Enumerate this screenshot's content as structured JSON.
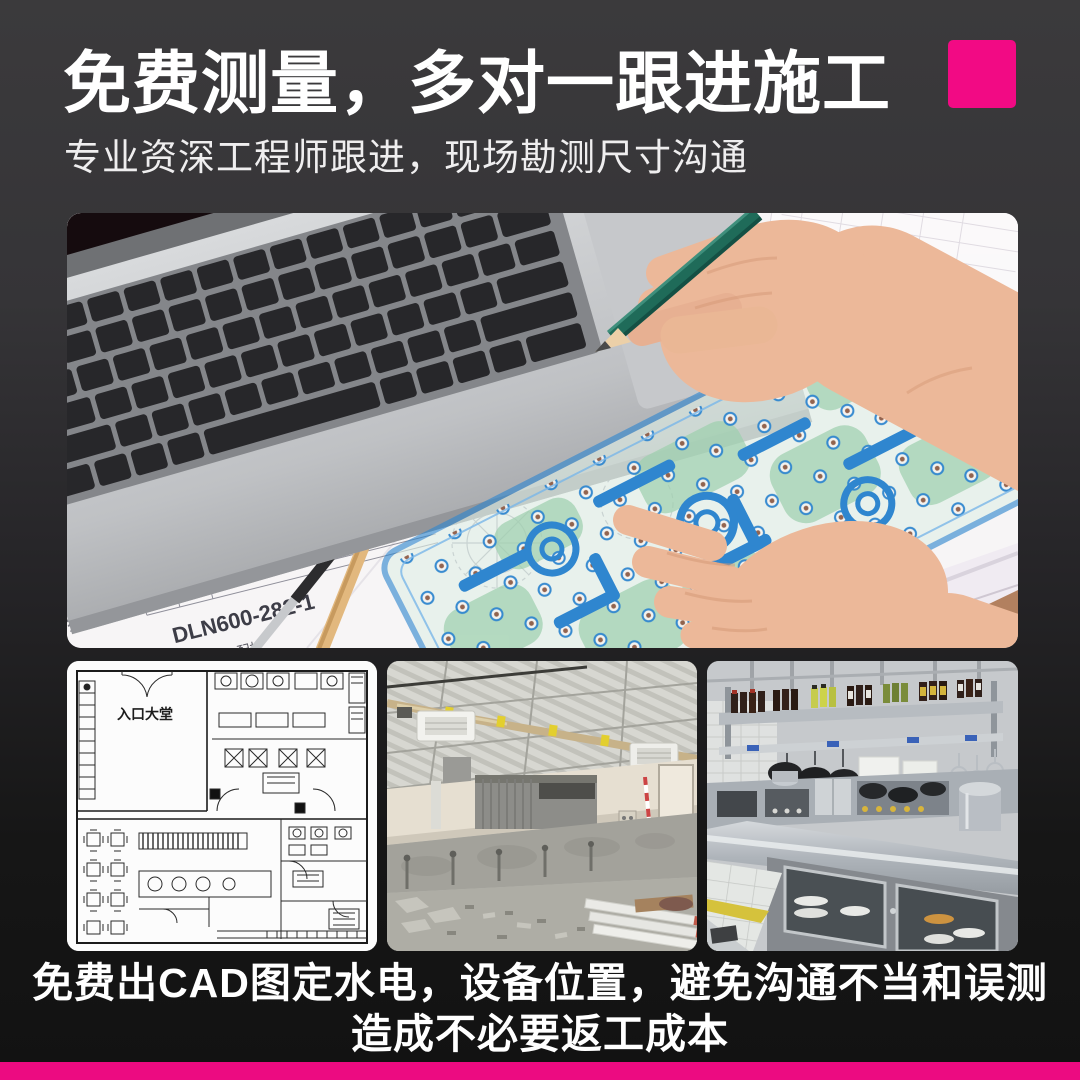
{
  "page": {
    "accent_pink": "#f20a84",
    "bottom_bar_pink": "#ec0b81",
    "bg_top": "#3a393b",
    "bg_bottom": "#121212"
  },
  "header": {
    "title": "免费测量，多对一跟进施工",
    "subtitle": "专业资深工程师跟进，现场勘测尺寸沟通"
  },
  "hero": {
    "paper": {
      "set_label": "全船2套",
      "c11": "570",
      "c12": "570",
      "c21": "2.4",
      "c22": "9.6",
      "c23": "φ350/φ330-1500",
      "c31": "156",
      "c32": "156",
      "c41": "866",
      "c42": "1732",
      "c51": "单重",
      "c52": "总重",
      "part_no": "DLN600-282-1",
      "machine_label": "6000M3配机",
      "system_label": "系统",
      "material_label": "料"
    }
  },
  "thumbnails": {
    "floorplan": {
      "lobby_label": "入口大堂"
    }
  },
  "footer": {
    "line1": "免费出CAD图定水电，设备位置，避免沟通不当和误测",
    "line2": "造成不必要返工成本"
  }
}
